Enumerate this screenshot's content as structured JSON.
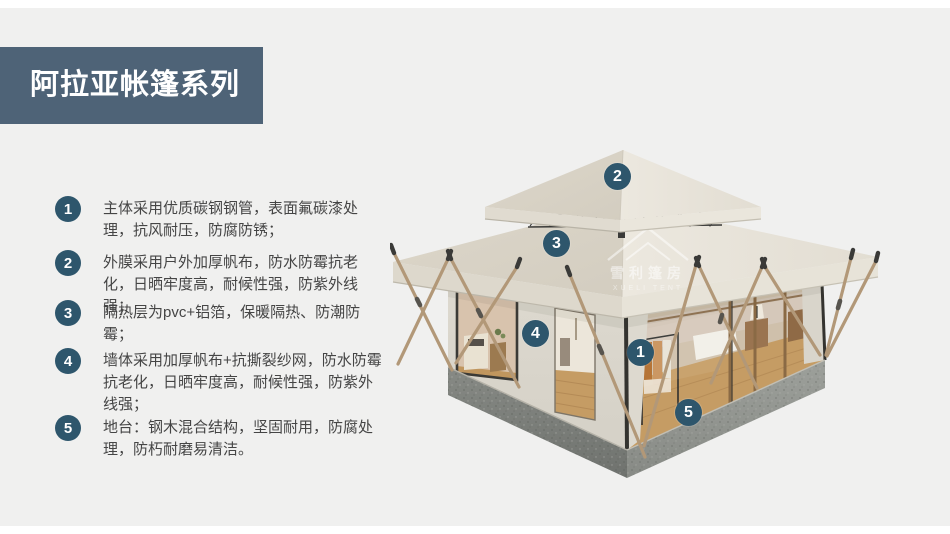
{
  "header": {
    "title": "阿拉亚帐篷系列",
    "banner_color": "#4e6377"
  },
  "features": [
    {
      "number": "1",
      "text": "主体采用优质碳钢钢管，表面氟碳漆处理，抗风耐压，防腐防锈；"
    },
    {
      "number": "2",
      "text": "外膜采用户外加厚帆布，防水防霉抗老化，日晒牢度高，耐候性强，防紫外线强；"
    },
    {
      "number": "3",
      "text": "隔热层为pvc+铝箔，保暖隔热、防潮防霉；"
    },
    {
      "number": "4",
      "text": "墙体采用加厚帆布+抗撕裂纱网，防水防霉抗老化，日晒牢度高，耐候性强，防紫外线强；"
    },
    {
      "number": "5",
      "text": "地台：钢木混合结构，坚固耐用，防腐处理，防朽耐磨易清洁。"
    }
  ],
  "tent": {
    "badges": [
      {
        "number": "1"
      },
      {
        "number": "2"
      },
      {
        "number": "3"
      },
      {
        "number": "4"
      },
      {
        "number": "5"
      }
    ],
    "watermark": {
      "line1": "雪利篷房",
      "line2": "XUELI TENT"
    }
  },
  "colors": {
    "background": "#f0f0ef",
    "badge": "#2e566c",
    "banner": "#4e6377",
    "canvas": "#e6e2d7",
    "platform": "#8d908c"
  }
}
